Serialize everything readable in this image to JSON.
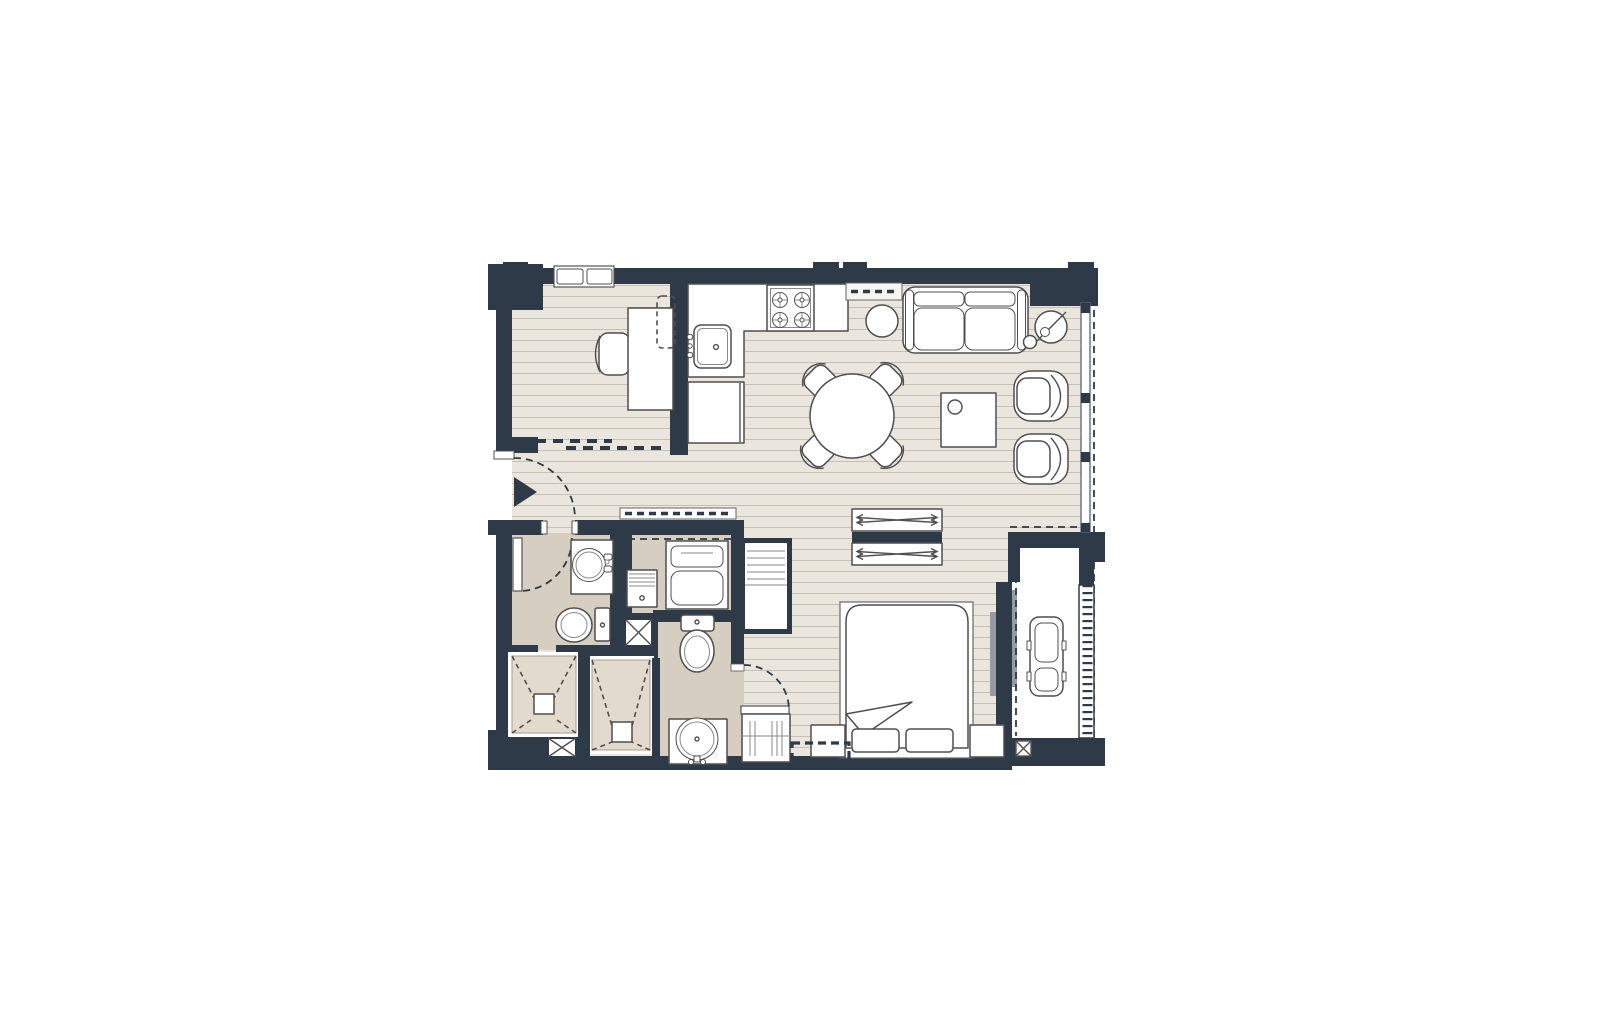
{
  "scene": {
    "type": "apartment-floor-plan",
    "width": 1600,
    "height": 1035
  },
  "palette": {
    "bg": "#ffffff",
    "wall": "#2e3a48",
    "wood": "#eae6de",
    "wood_line": "#c6c0b2",
    "bath": "#d6cec0",
    "shower": "#e2dbcd",
    "balcony": "#ffffff",
    "outline": "#4f4f4f",
    "glass": "#949ba3"
  },
  "rooms": [
    {
      "name": "entry-hall",
      "furniture": [
        "entrance-door",
        "direction-arrow"
      ]
    },
    {
      "name": "den",
      "furniture": [
        "desk",
        "desk-chair",
        "monitor-dashed",
        "window",
        "sliding-door"
      ]
    },
    {
      "name": "kitchen",
      "furniture": [
        "l-counter",
        "kitchen-sink",
        "gas-stove",
        "refrigerator",
        "upper-cabinet-dashed"
      ]
    },
    {
      "name": "living-dining",
      "furniture": [
        "sofa",
        "floor-lamp",
        "side-table",
        "dining-table",
        "dining-chairs",
        "coffee-table",
        "armchair",
        "armchair",
        "window-wall"
      ]
    },
    {
      "name": "bathroom",
      "furniture": [
        "washbasin",
        "toilet",
        "shower",
        "swing-door"
      ]
    },
    {
      "name": "laundry-niche",
      "furniture": [
        "washing-machine",
        "laundry-cabinet",
        "overhead-shelf-dashed"
      ]
    },
    {
      "name": "ensuite-bathroom",
      "furniture": [
        "washbasin",
        "toilet",
        "shower",
        "swing-door"
      ]
    },
    {
      "name": "bedroom",
      "furniture": [
        "double-bed",
        "nightstand",
        "nightstand",
        "bench-dashed",
        "sliding-wardrobe",
        "sliding-wardrobe",
        "shelving-unit",
        "dresser",
        "sliding-glass-door"
      ]
    },
    {
      "name": "balcony",
      "furniture": [
        "lounge-chair",
        "louver-screen",
        "drain-box"
      ]
    }
  ],
  "symbols": [
    "duct-x-box",
    "duct-x-box",
    "drain-box",
    "shower-drain",
    "shower-drain",
    "door-swing-arc",
    "wall-protrusion"
  ]
}
